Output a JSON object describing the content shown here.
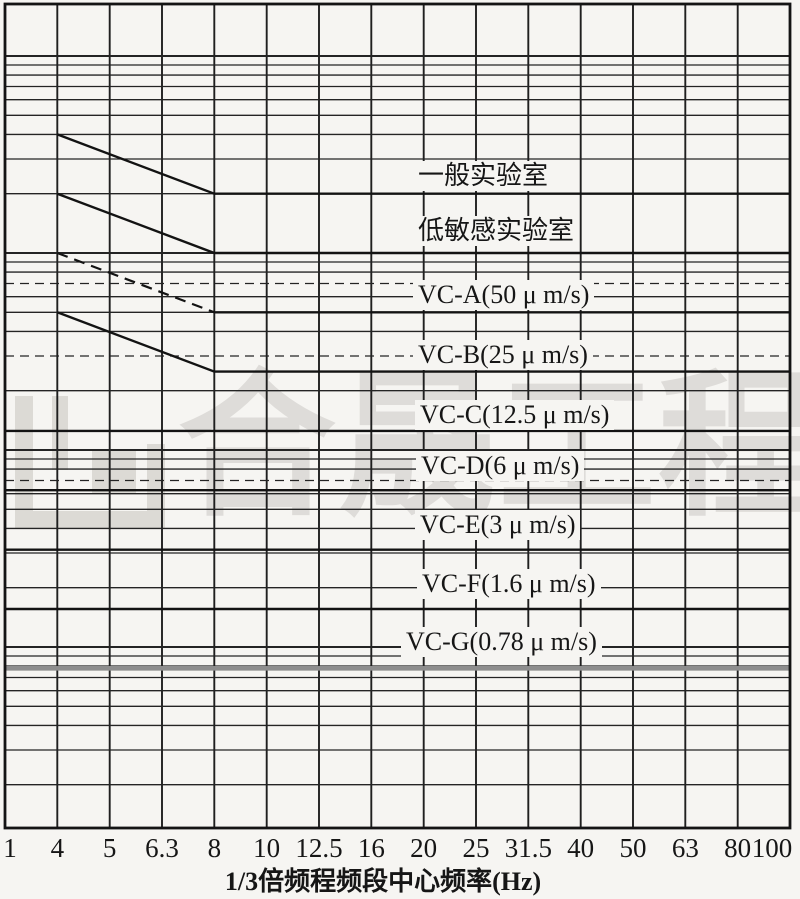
{
  "page": {
    "background_color": "#f6f5f2",
    "line_color": "#1b1b1b",
    "watermark_logo": "construction-company-logo",
    "unit": "μm/s"
  },
  "chart_data": {
    "type": "line",
    "title": "",
    "xlabel": "1/3倍频程频段中心频率(Hz)",
    "ylabel": "",
    "x_scale": "one-third-octave-bands-log",
    "y_scale": "log",
    "y_unit": "μm/s",
    "ylim_approx": [
      0.12,
      1800
    ],
    "grid": true,
    "y_axis_labels_visible": false,
    "legend_position": "labels-on-lines",
    "x_ticks": [
      "1",
      "4",
      "5",
      "6.3",
      "8",
      "10",
      "12.5",
      "16",
      "20",
      "25",
      "31.5",
      "40",
      "50",
      "63",
      "80",
      "100"
    ],
    "y_gridlines": [
      1000,
      900,
      800,
      700,
      600,
      500,
      400,
      300,
      200,
      100,
      90,
      80,
      70,
      60,
      50,
      40,
      30,
      20,
      10,
      9,
      8,
      7,
      6,
      5,
      4,
      3,
      2,
      1,
      0.9,
      0.8,
      0.7,
      0.6,
      0.5,
      0.4,
      0.3,
      0.2
    ],
    "y_gridlines_dashed": [
      70,
      30,
      7
    ],
    "series": [
      {
        "id": "general-lab",
        "label": "一般实验室",
        "flat_velocity_um_s": 200,
        "points": [
          [
            4,
            400
          ],
          [
            8,
            200
          ],
          [
            100,
            200
          ]
        ],
        "slope_dashed": false,
        "thick_gray": false,
        "label_x": 413,
        "label_y": 161
      },
      {
        "id": "low-sensitive-lab",
        "label": "低敏感实验室",
        "flat_velocity_um_s": 100,
        "points": [
          [
            4,
            200
          ],
          [
            8,
            100
          ],
          [
            100,
            100
          ]
        ],
        "slope_dashed": false,
        "thick_gray": false,
        "label_x": 413,
        "label_y": 216
      },
      {
        "id": "vc-a",
        "label": "VC-A(50 μ m/s)",
        "flat_velocity_um_s": 50,
        "points": [
          [
            4,
            100
          ],
          [
            8,
            50
          ],
          [
            100,
            50
          ]
        ],
        "slope_dashed": true,
        "thick_gray": false,
        "label_x": 413,
        "label_y": 280
      },
      {
        "id": "vc-b",
        "label": "VC-B(25 μ m/s)",
        "flat_velocity_um_s": 25,
        "points": [
          [
            4,
            50
          ],
          [
            8,
            25
          ],
          [
            100,
            25
          ]
        ],
        "slope_dashed": false,
        "thick_gray": false,
        "label_x": 413,
        "label_y": 340
      },
      {
        "id": "vc-c",
        "label": "VC-C(12.5 μ m/s)",
        "flat_velocity_um_s": 12.5,
        "points": [
          [
            1,
            12.5
          ],
          [
            100,
            12.5
          ]
        ],
        "slope_dashed": false,
        "thick_gray": false,
        "label_x": 415,
        "label_y": 400
      },
      {
        "id": "vc-d",
        "label": "VC-D(6 μ m/s)",
        "flat_velocity_um_s": 6.25,
        "points": [
          [
            1,
            6.25
          ],
          [
            100,
            6.25
          ]
        ],
        "slope_dashed": false,
        "thick_gray": false,
        "label_x": 416,
        "label_y": 451
      },
      {
        "id": "vc-e",
        "label": "VC-E(3 μ m/s)",
        "flat_velocity_um_s": 3.12,
        "points": [
          [
            1,
            3.12
          ],
          [
            100,
            3.12
          ]
        ],
        "slope_dashed": false,
        "thick_gray": false,
        "label_x": 415,
        "label_y": 510
      },
      {
        "id": "vc-f",
        "label": "VC-F(1.6 μ m/s)",
        "flat_velocity_um_s": 1.56,
        "points": [
          [
            1,
            1.56
          ],
          [
            100,
            1.56
          ]
        ],
        "slope_dashed": false,
        "thick_gray": false,
        "label_x": 417,
        "label_y": 569
      },
      {
        "id": "vc-g",
        "label": "VC-G(0.78 μ m/s)",
        "flat_velocity_um_s": 0.78,
        "points": [
          [
            1,
            0.78
          ],
          [
            100,
            0.78
          ]
        ],
        "slope_dashed": false,
        "thick_gray": true,
        "label_x": 401,
        "label_y": 627
      }
    ],
    "watermark": {
      "text": "合晟工程"
    }
  }
}
